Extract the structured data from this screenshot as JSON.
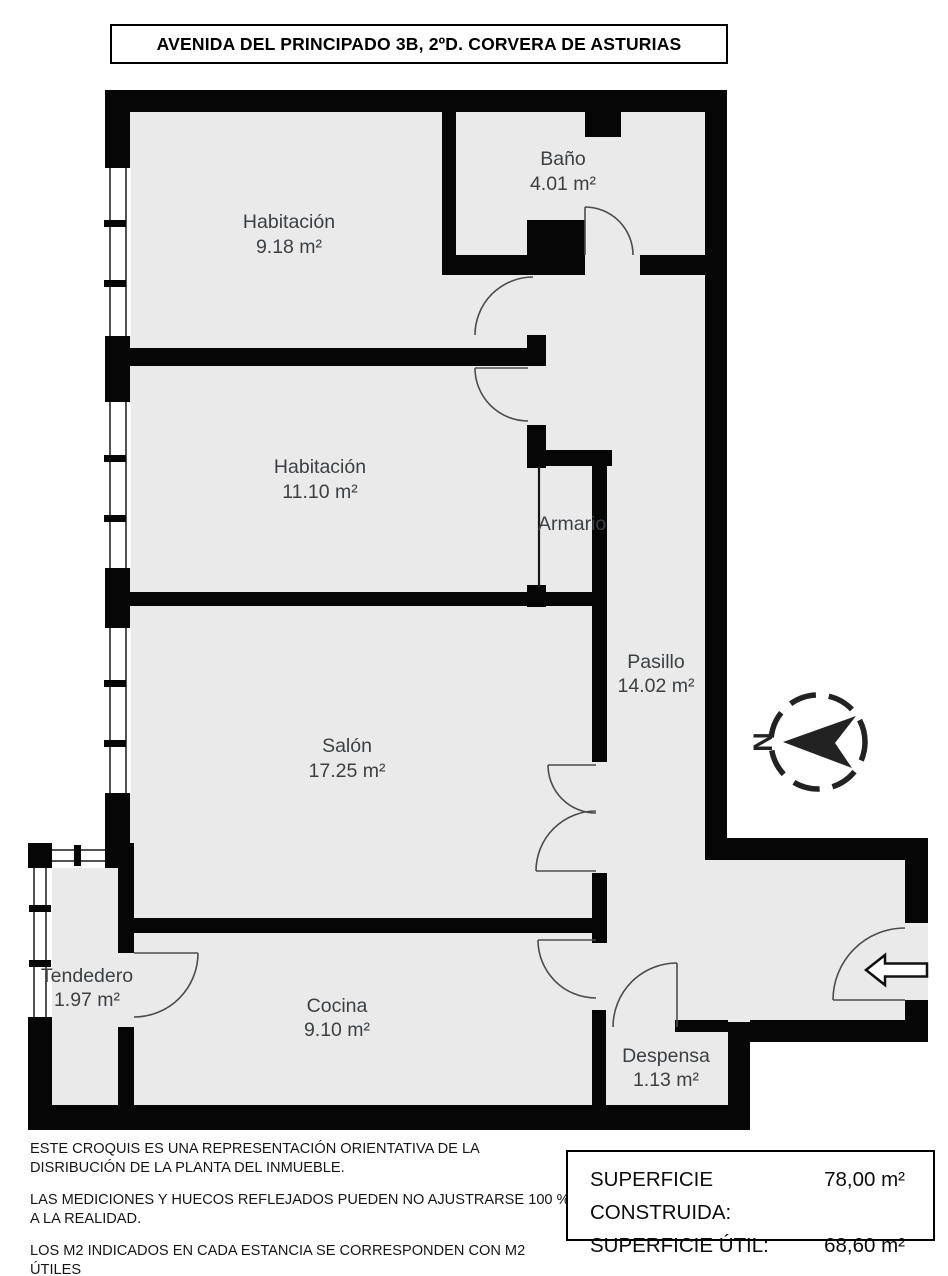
{
  "title": "AVENIDA DEL PRINCIPADO 3B, 2ºD. CORVERA DE ASTURIAS",
  "rooms": {
    "habitacion1": {
      "name": "Habitación",
      "area": "9.18 m²"
    },
    "bano": {
      "name": "Baño",
      "area": "4.01 m²"
    },
    "habitacion2": {
      "name": "Habitación",
      "area": "11.10 m²"
    },
    "armario": {
      "name": "Armario"
    },
    "pasillo": {
      "name": "Pasillo",
      "area": "14.02 m²"
    },
    "salon": {
      "name": "Salón",
      "area": "17.25 m²"
    },
    "tendedero": {
      "name": "Tendedero",
      "area": "1.97 m²"
    },
    "cocina": {
      "name": "Cocina",
      "area": "9.10 m²"
    },
    "despensa": {
      "name": "Despensa",
      "area": "1.13 m²"
    }
  },
  "compass": {
    "north_label": "N"
  },
  "disclaimer": {
    "line1": "ESTE CROQUIS ES UNA REPRESENTACIÓN ORIENTATIVA DE LA DISRIBUCIÓN DE LA PLANTA DEL INMUEBLE.",
    "line2": "LAS MEDICIONES Y HUECOS REFLEJADOS PUEDEN NO AJUSTRARSE 100 % A LA REALIDAD.",
    "line3": "LOS M2 INDICADOS EN CADA ESTANCIA SE CORRESPONDEN CON M2 ÚTILES"
  },
  "summary": {
    "construida_label": "SUPERFICIE CONSTRUIDA:",
    "construida_value": "78,00 m²",
    "util_label": "SUPERFICIE ÚTIL:",
    "util_value": "68,60 m²"
  },
  "colors": {
    "wall": "#060606",
    "floor": "#eaeaea",
    "door_stroke": "#4c4c4c",
    "label_text": "#3d4043"
  }
}
